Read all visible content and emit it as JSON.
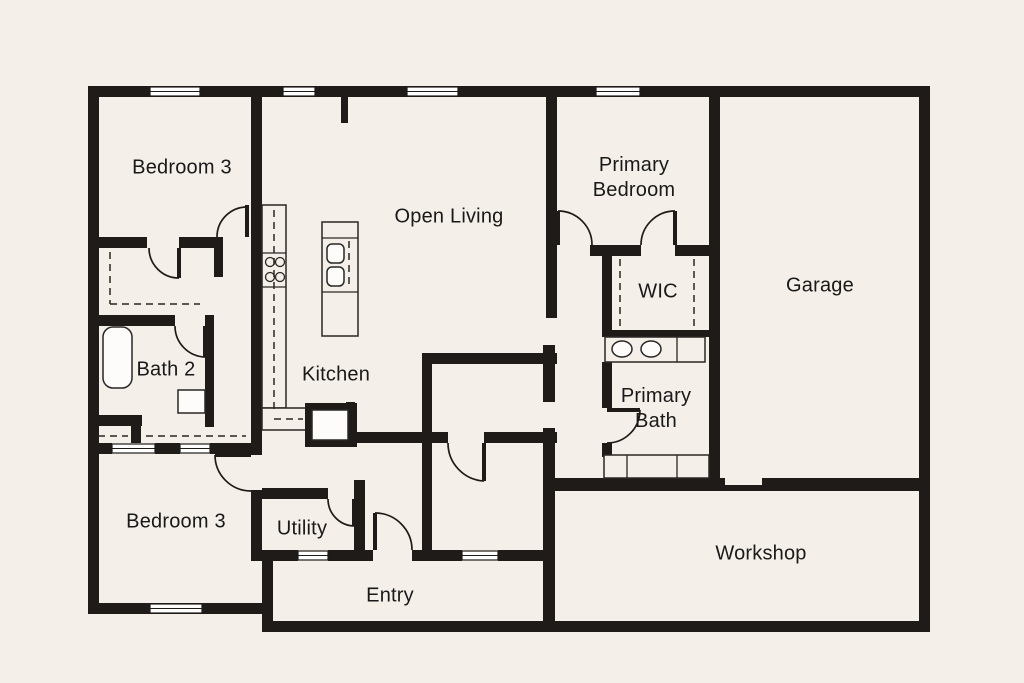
{
  "plan": {
    "title": "Single-story floor plan",
    "canvas": {
      "width": 1024,
      "height": 683
    },
    "colors": {
      "background": "#f4f0e9",
      "wall": "#1e1b18",
      "label": "#191919"
    }
  },
  "rooms": [
    {
      "id": "bedroom-3-upper",
      "label": "Bedroom 3",
      "x": 182,
      "y": 168
    },
    {
      "id": "open-living",
      "label": "Open Living",
      "x": 449,
      "y": 217
    },
    {
      "id": "primary-bedroom",
      "label": "Primary\nBedroom",
      "x": 634,
      "y": 178
    },
    {
      "id": "garage",
      "label": "Garage",
      "x": 820,
      "y": 286
    },
    {
      "id": "wic",
      "label": "WIC",
      "x": 658,
      "y": 292
    },
    {
      "id": "bath-2",
      "label": "Bath 2",
      "x": 166,
      "y": 370
    },
    {
      "id": "kitchen",
      "label": "Kitchen",
      "x": 336,
      "y": 375
    },
    {
      "id": "primary-bath",
      "label": "Primary\nBath",
      "x": 656,
      "y": 409
    },
    {
      "id": "bedroom-3-lower",
      "label": "Bedroom 3",
      "x": 176,
      "y": 522
    },
    {
      "id": "utility",
      "label": "Utility",
      "x": 302,
      "y": 529
    },
    {
      "id": "entry",
      "label": "Entry",
      "x": 390,
      "y": 596
    },
    {
      "id": "workshop",
      "label": "Workshop",
      "x": 761,
      "y": 554
    }
  ],
  "fixtures": [
    "bathtub",
    "toilet",
    "double-sink-vanity",
    "walk-in-shower",
    "kitchen-island-sink",
    "cooktop-burners",
    "range-oven",
    "kitchen-counter",
    "closet-rod-lines",
    "sliding-closet-doors"
  ]
}
